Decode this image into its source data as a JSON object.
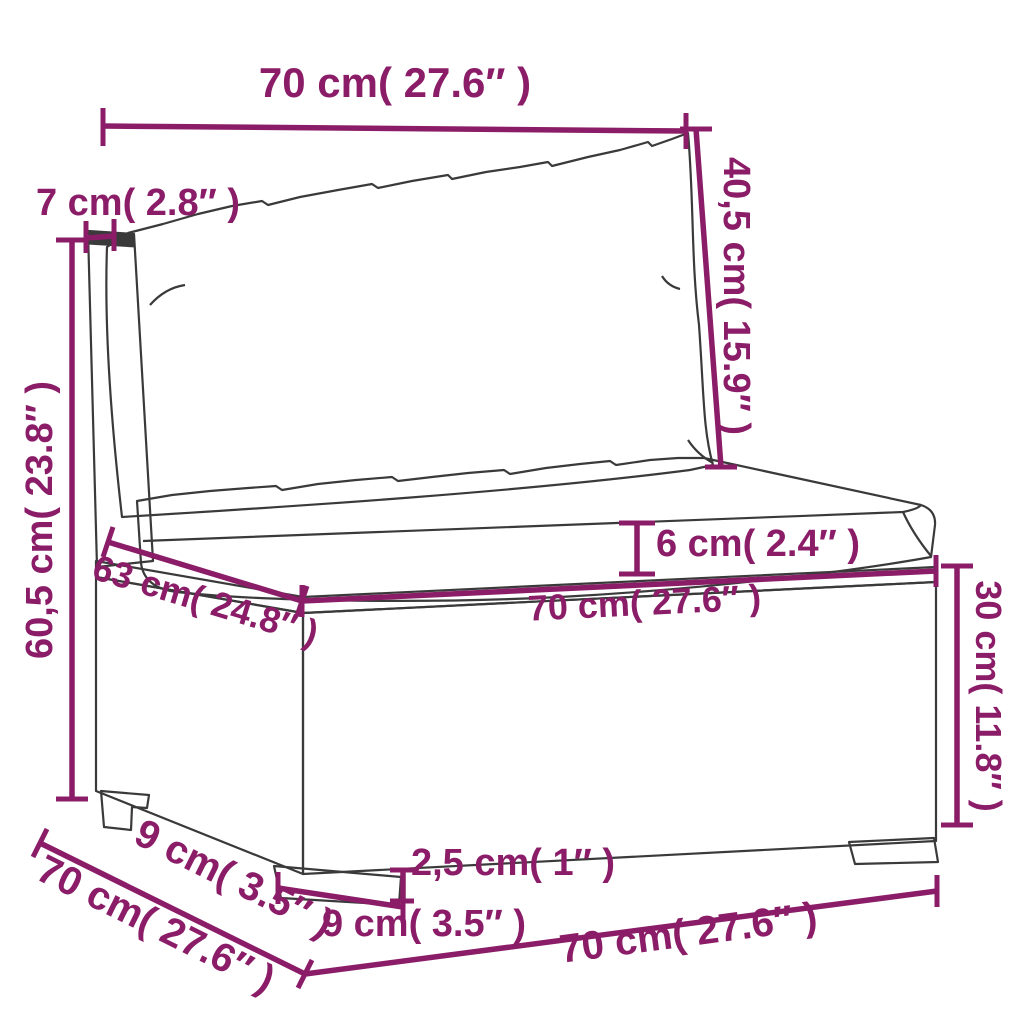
{
  "diagram": {
    "subject": "poly rattan middle sofa section with cushions - dimension drawing",
    "colors": {
      "dimension_accent": "#8B1D68",
      "outline": "#3A3A3A",
      "background": "#FFFFFF",
      "cushion_fill": "#FBFAF7",
      "post_cap_fill": "#3A3A3A"
    },
    "dims": {
      "back_width": "70 cm( 27.6″ )",
      "post_depth": "7 cm( 2.8″ )",
      "back_cushion_height": "40,5 cm( 15.9″ )",
      "total_height": "60,5 cm( 23.8″ )",
      "seat_depth": "63 cm( 24.8″ )",
      "seat_width": "70 cm( 27.6″ )",
      "cushion_thickness": "6 cm( 2.4″ )",
      "base_height": "30 cm( 11.8″ )",
      "foot_inset_diagonal": "9 cm( 3.5″ )",
      "depth_diagonal": "70 cm( 27.6″ )",
      "foot_width": "9 cm( 3.5″ )",
      "foot_height": "2,5 cm( 1″ )",
      "bottom_width": "70 cm( 27.6″ )"
    }
  }
}
